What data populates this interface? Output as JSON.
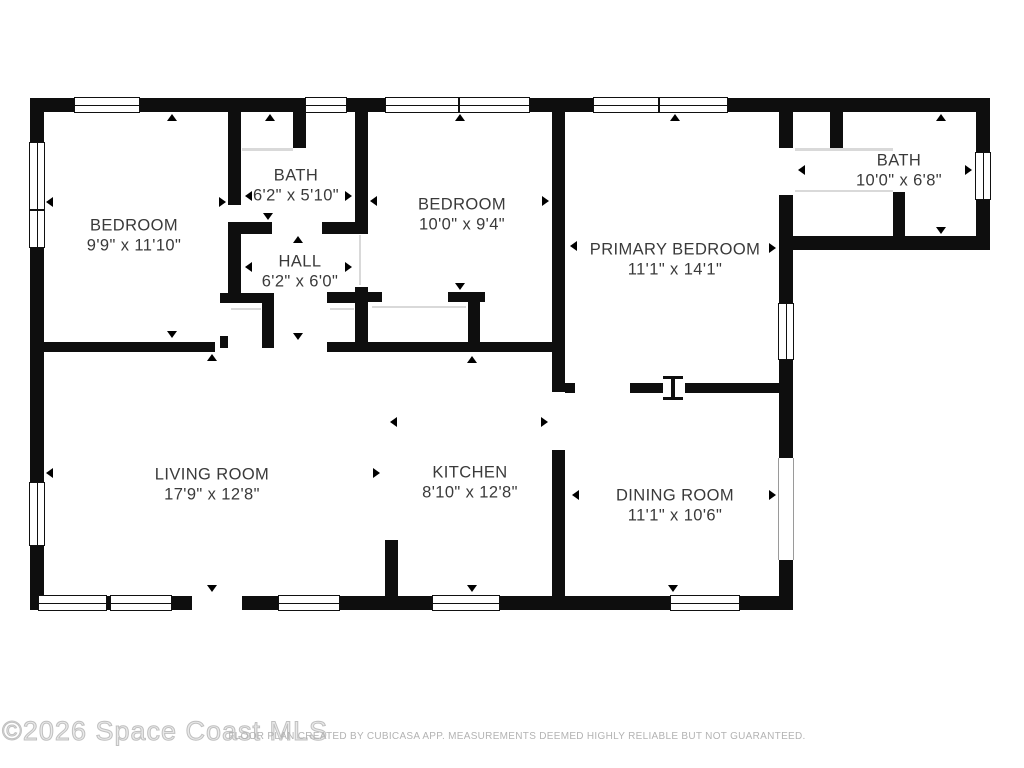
{
  "watermark": "©2026 Space Coast MLS",
  "footer": "FLOOR PLAN CREATED BY CUBICASA APP. MEASUREMENTS DEEMED HIGHLY RELIABLE BUT NOT GUARANTEED.",
  "rooms": [
    {
      "name": "BEDROOM",
      "dims": "9'9\" x 11'10\""
    },
    {
      "name": "BATH",
      "dims": "6'2\" x 5'10\""
    },
    {
      "name": "HALL",
      "dims": "6'2\" x 6'0\""
    },
    {
      "name": "BEDROOM",
      "dims": "10'0\" x 9'4\""
    },
    {
      "name": "PRIMARY BEDROOM",
      "dims": "11'1\" x 14'1\""
    },
    {
      "name": "BATH",
      "dims": "10'0\" x 6'8\""
    },
    {
      "name": "LIVING ROOM",
      "dims": "17'9\" x 12'8\""
    },
    {
      "name": "KITCHEN",
      "dims": "8'10\" x 12'8\""
    },
    {
      "name": "DINING ROOM",
      "dims": "11'1\" x 10'6\""
    }
  ]
}
